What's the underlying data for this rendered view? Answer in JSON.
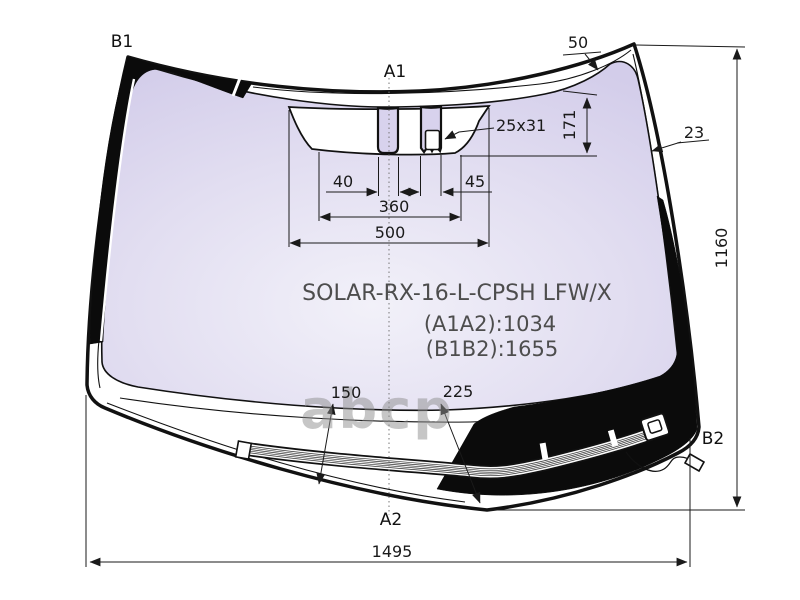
{
  "diagram": {
    "part_code": "SOLAR-RX-16-L-CPSH LFW/X",
    "dim_a1a2": "(A1A2):1034",
    "dim_b1b2": "(B1B2):1655"
  },
  "labels": {
    "top_left": "B1",
    "top_center": "A1",
    "bottom_right": "B2",
    "bottom_center": "A2"
  },
  "dimensions": {
    "top_band_width": "50",
    "sensor_offset_height": "171",
    "sensor_window_size": "25x31",
    "side_band_width": "23",
    "bracket_gap_left": "40",
    "bracket_gap_right": "45",
    "cutout_inner_width": "360",
    "cutout_outer_width": "500",
    "glass_height": "1160",
    "deicer_left_height": "150",
    "deicer_center_height": "225",
    "glass_width": "1495"
  },
  "watermark": "abcp",
  "colors": {
    "glass_center": "#f2f1f9",
    "glass_mid": "#e2def1",
    "glass_edge": "#d3cdea",
    "bracket_fill": "#d8d2ed",
    "frit": "#0b0b0b",
    "line": "#1a1a1a",
    "part_text": "#4d4d4d",
    "watermark": "#8f8f8f"
  }
}
